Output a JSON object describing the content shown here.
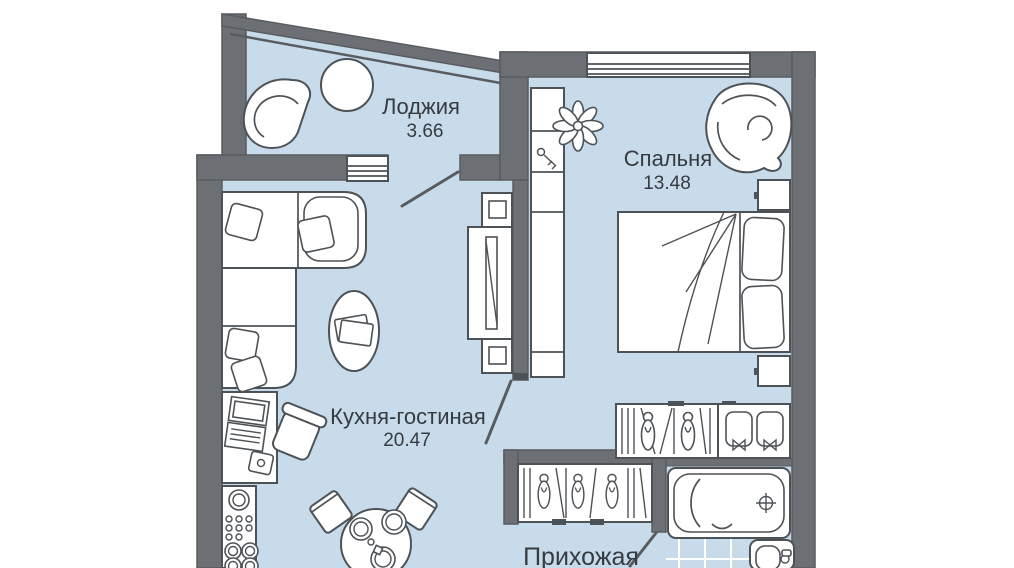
{
  "rooms": {
    "loggia": {
      "label": "Лоджия",
      "area": "3.66"
    },
    "bedroom": {
      "label": "Спальня",
      "area": "13.48"
    },
    "kitchen": {
      "label": "Кухня-гостиная",
      "area": "20.47"
    },
    "hallway": {
      "label": "Прихожая",
      "area": ""
    }
  },
  "colors": {
    "wall": "#6c7074",
    "wall-edge": "#585c60",
    "floor": "#c8dbea",
    "outline": "#4d5257",
    "text": "#363b42",
    "bg": "#ffffff"
  }
}
